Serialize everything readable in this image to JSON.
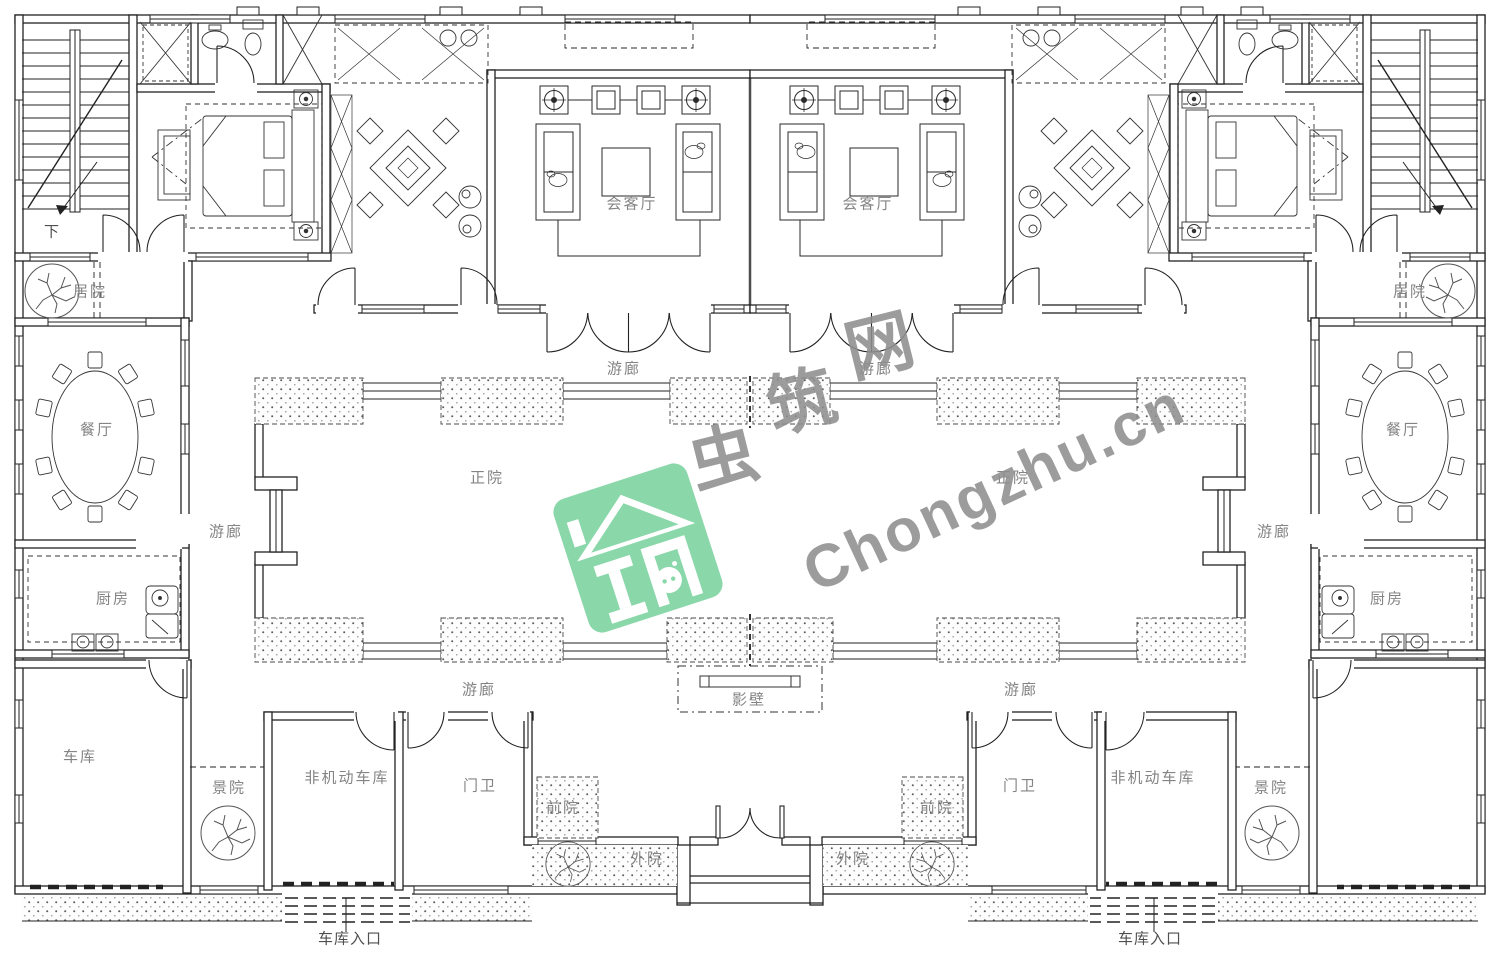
{
  "page": {
    "background": "#ffffff"
  },
  "plan": {
    "label_color": "#848484",
    "label_color_dark": "#4f4f4f",
    "labels": [
      {
        "name": "reception-hall-left",
        "text": "会客厅",
        "x": 632,
        "y": 203
      },
      {
        "name": "reception-hall-right",
        "text": "会客厅",
        "x": 868,
        "y": 203
      },
      {
        "name": "stairs-down",
        "text": "下",
        "x": 52,
        "y": 231,
        "dark": true
      },
      {
        "name": "residence-court-left",
        "text": "居院",
        "x": 90,
        "y": 291
      },
      {
        "name": "residence-court-right",
        "text": "居院",
        "x": 1410,
        "y": 291
      },
      {
        "name": "veranda-top-left",
        "text": "游廊",
        "x": 624,
        "y": 368
      },
      {
        "name": "veranda-top-right",
        "text": "游廊",
        "x": 876,
        "y": 368
      },
      {
        "name": "veranda-left",
        "text": "游廊",
        "x": 226,
        "y": 531
      },
      {
        "name": "veranda-right",
        "text": "游廊",
        "x": 1274,
        "y": 531
      },
      {
        "name": "veranda-bottom-left",
        "text": "游廊",
        "x": 479,
        "y": 689
      },
      {
        "name": "veranda-bottom-right",
        "text": "游廊",
        "x": 1021,
        "y": 689
      },
      {
        "name": "main-court-left",
        "text": "正院",
        "x": 487,
        "y": 477
      },
      {
        "name": "main-court-right",
        "text": "正院",
        "x": 1013,
        "y": 477
      },
      {
        "name": "dining-room-left",
        "text": "餐厅",
        "x": 97,
        "y": 429
      },
      {
        "name": "dining-room-right",
        "text": "餐厅",
        "x": 1403,
        "y": 429
      },
      {
        "name": "kitchen-left",
        "text": "厨房",
        "x": 113,
        "y": 598
      },
      {
        "name": "kitchen-right",
        "text": "厨房",
        "x": 1387,
        "y": 598
      },
      {
        "name": "garage-left",
        "text": "车库",
        "x": 80,
        "y": 756
      },
      {
        "name": "bike-garage-left",
        "text": "非机动车库",
        "x": 347,
        "y": 777
      },
      {
        "name": "bike-garage-right",
        "text": "非机动车库",
        "x": 1153,
        "y": 777
      },
      {
        "name": "guard-room-left",
        "text": "门卫",
        "x": 480,
        "y": 785
      },
      {
        "name": "guard-room-right",
        "text": "门卫",
        "x": 1020,
        "y": 785
      },
      {
        "name": "scenic-court-left",
        "text": "景院",
        "x": 229,
        "y": 787
      },
      {
        "name": "scenic-court-right",
        "text": "景院",
        "x": 1271,
        "y": 787
      },
      {
        "name": "front-court-left",
        "text": "前院",
        "x": 563,
        "y": 807
      },
      {
        "name": "front-court-right",
        "text": "前院",
        "x": 937,
        "y": 807
      },
      {
        "name": "outer-court-left",
        "text": "外院",
        "x": 647,
        "y": 858
      },
      {
        "name": "outer-court-right",
        "text": "外院",
        "x": 853,
        "y": 858
      },
      {
        "name": "screen-wall",
        "text": "影壁",
        "x": 749,
        "y": 699
      },
      {
        "name": "garage-entrance-left",
        "text": "车库入口",
        "x": 350,
        "y": 938,
        "dark": true
      },
      {
        "name": "garage-entrance-right",
        "text": "车库入口",
        "x": 1150,
        "y": 938,
        "dark": true
      }
    ]
  },
  "watermark": {
    "logo_color": "#84d5a6",
    "brand_cn": "虫筑网",
    "brand_cn_chars": [
      {
        "ch": "虫",
        "x": 722,
        "y": 452
      },
      {
        "ch": "筑",
        "x": 800,
        "y": 396
      },
      {
        "ch": "网",
        "x": 878,
        "y": 340
      }
    ],
    "brand_en": "Chongzhu.cn",
    "text_color": "#8f8f8f"
  }
}
